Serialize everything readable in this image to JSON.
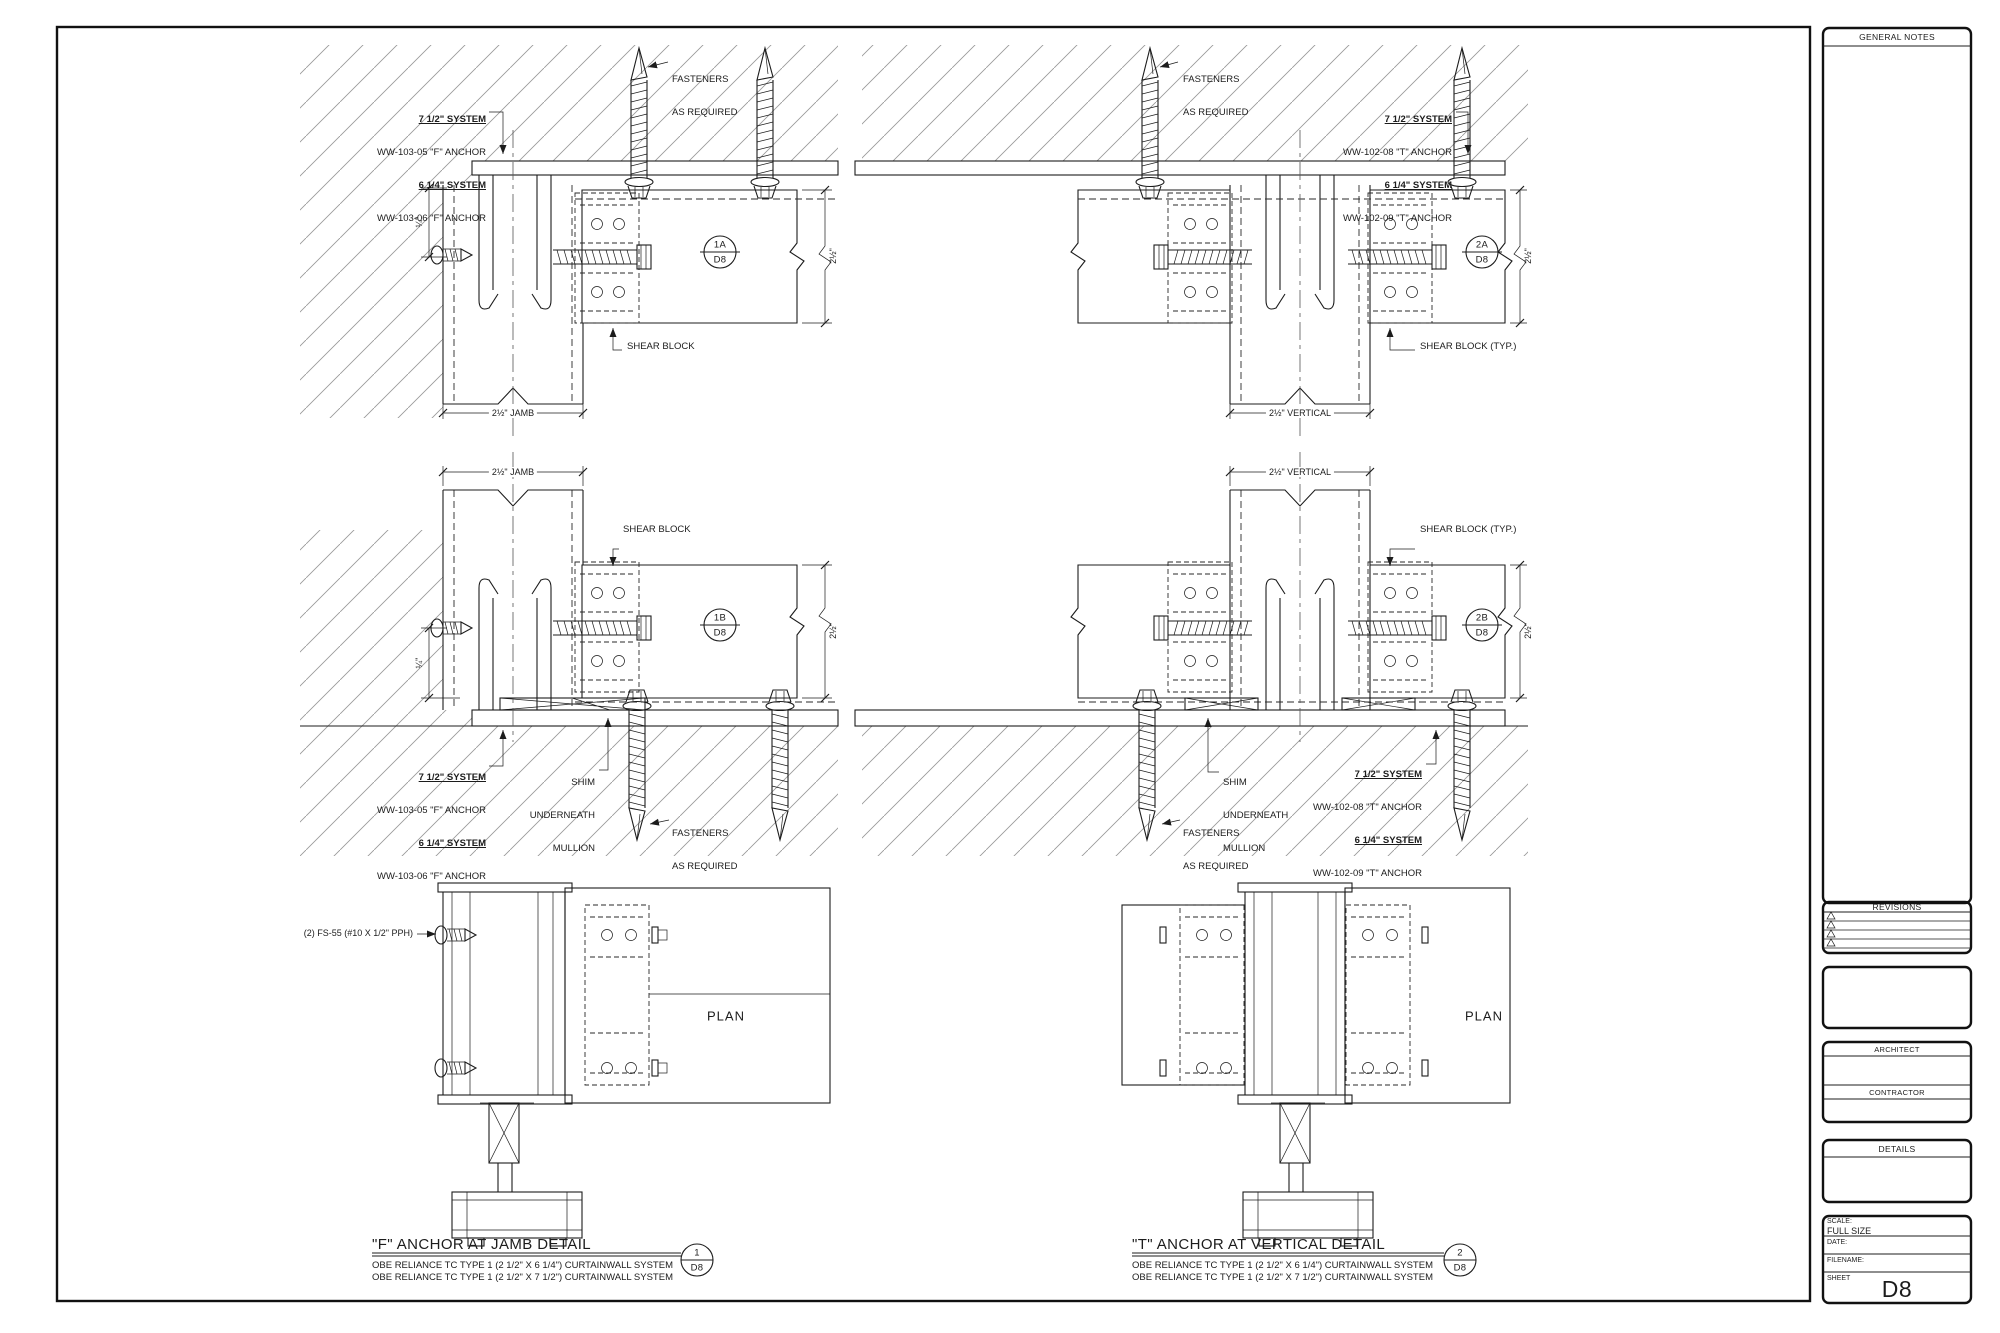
{
  "labels": {
    "fasteners_l1": "FASTENERS",
    "fasteners_l2": "AS REQUIRED",
    "shear_block": "SHEAR BLOCK",
    "shear_block_typ": "SHEAR BLOCK (TYP.)",
    "shim_l1": "SHIM",
    "shim_l2": "UNDERNEATH",
    "shim_l3": "MULLION",
    "fs55": "(2) FS-55 (#10 X 1/2\" PPH)",
    "plan": "PLAN",
    "f_anchor": {
      "l1": "7 1/2\" SYSTEM",
      "l2": "WW-103-05 \"F\" ANCHOR",
      "l3": "6 1/4\" SYSTEM",
      "l4": "WW-103-06 \"F\" ANCHOR"
    },
    "t_anchor": {
      "l1": "7 1/2\" SYSTEM",
      "l2": "WW-102-08 \"T\" ANCHOR",
      "l3": "6 1/4\" SYSTEM",
      "l4": "WW-102-09 \"T\" ANCHOR"
    }
  },
  "dims": {
    "jamb": "2½\" JAMB",
    "vertical": "2½\" VERTICAL",
    "quarter": "¼\"",
    "two_half": "2½\""
  },
  "bubbles": {
    "b1a": "1A",
    "b2a": "2A",
    "b1b": "1B",
    "b2b": "2B",
    "b1": "1",
    "b2": "2",
    "sheet": "D8"
  },
  "titles": {
    "detail1": "\"F\" ANCHOR AT JAMB DETAIL",
    "detail2": "\"T\" ANCHOR AT VERTICAL DETAIL",
    "sub1": "OBE RELIANCE TC TYPE 1 (2 1/2\" X 6 1/4\") CURTAINWALL SYSTEM",
    "sub2": "OBE RELIANCE TC TYPE 1 (2 1/2\" X 7 1/2\") CURTAINWALL SYSTEM"
  },
  "titleblock": {
    "general_notes": "GENERAL NOTES",
    "revisions": "REVISIONS",
    "architect": "ARCHITECT",
    "contractor": "CONTRACTOR",
    "details": "DETAILS",
    "scale_label": "SCALE:",
    "scale_value": "FULL SIZE",
    "date_label": "DATE:",
    "filename_label": "FILENAME:",
    "sheet_label": "SHEET",
    "sheet_number": "D8"
  },
  "colors": {
    "line": "#1c1c1c",
    "hatch": "#9a9a9a",
    "background": "#ffffff"
  }
}
